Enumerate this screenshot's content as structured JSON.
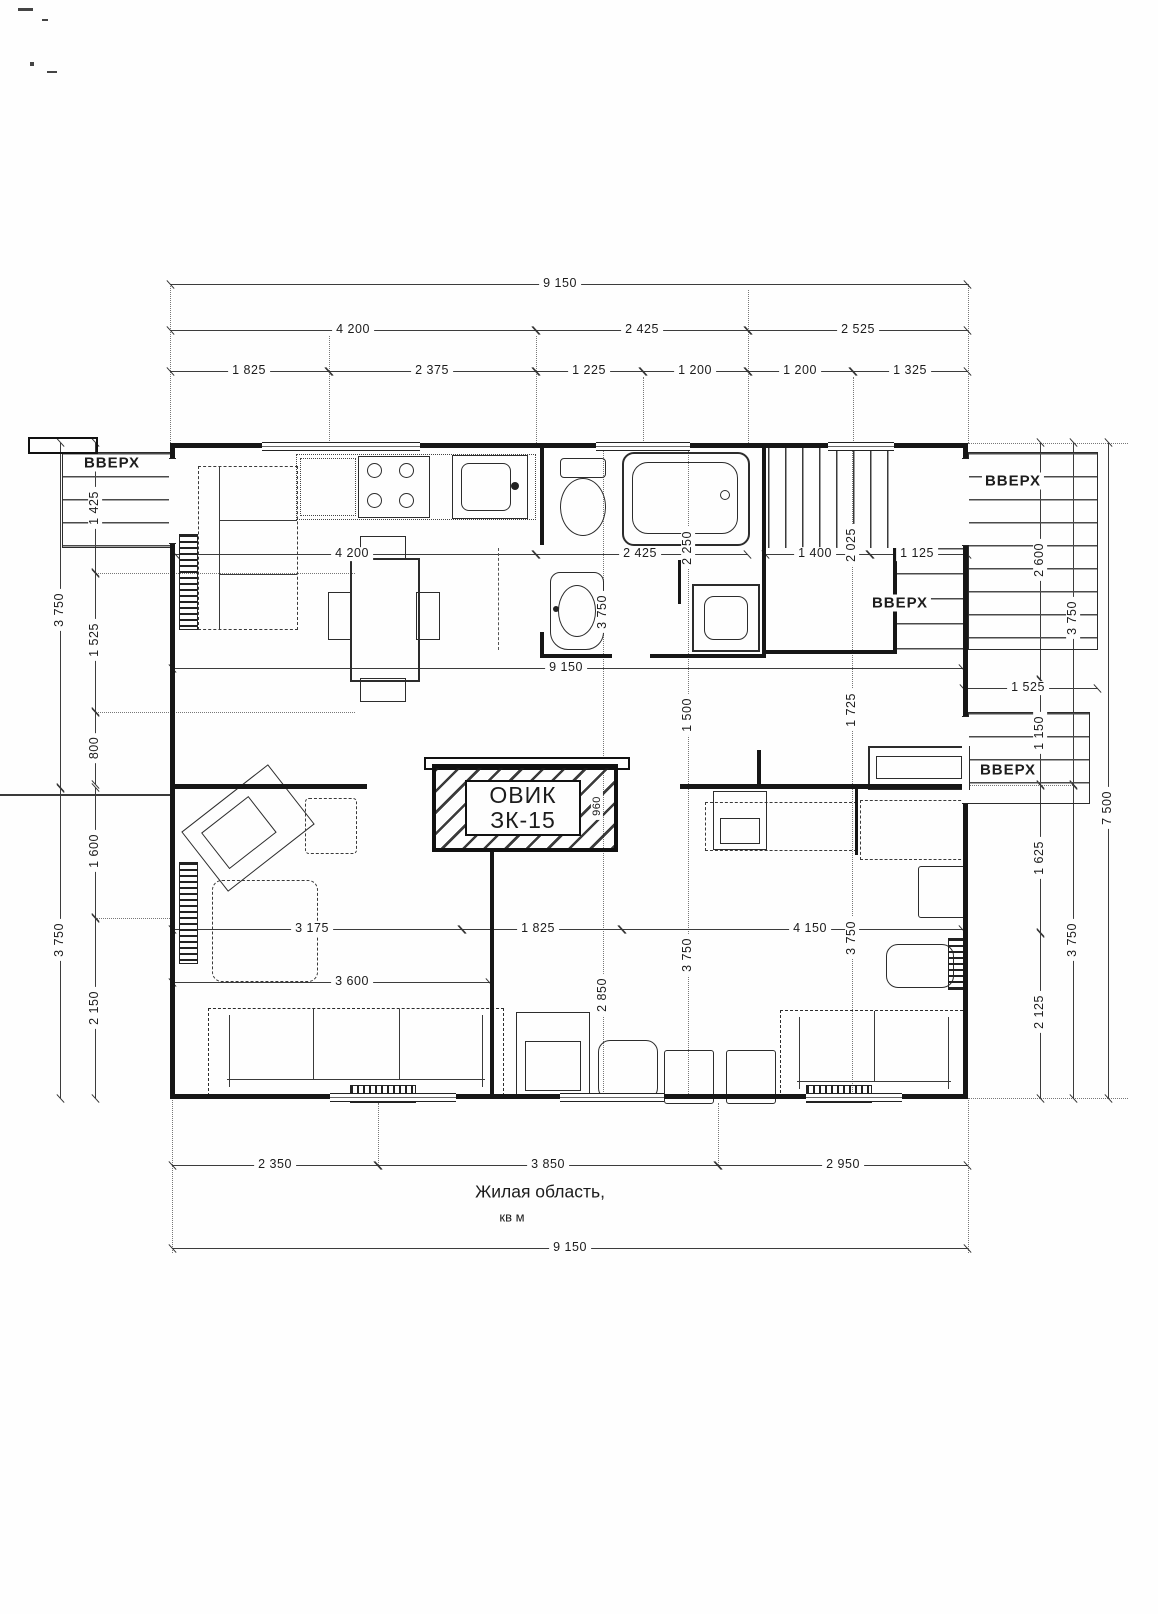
{
  "labels": {
    "up": "ВВЕРХ"
  },
  "furnace": {
    "line1": "ОВИК",
    "line2": "ЗК-15",
    "depth": "960"
  },
  "caption": {
    "line1": "Жилая область,",
    "line2": "кв м"
  },
  "colors": {
    "ink": "#1c1c1c",
    "paper": "#fefefe"
  },
  "dims": {
    "top_total": "9 150",
    "top_a": "4 200",
    "top_b": "2 425",
    "top_c": "2 525",
    "top_1": "1 825",
    "top_2": "2 375",
    "top_3": "1 225",
    "top_4": "1 200",
    "top_5": "1 200",
    "top_6": "1 325",
    "left_upper": "3 750",
    "left_lower": "3 750",
    "l1": "1 425",
    "l2": "1 525",
    "l3": "800",
    "l4": "1 600",
    "l5": "2 150",
    "r1": "2 600",
    "r2": "1 150",
    "r3": "1 625",
    "r4": "2 125",
    "right_upper": "3 750",
    "right_lower": "3 750",
    "right_total": "7 500",
    "m1": "4 200",
    "m2": "2 425",
    "m3": "1 400",
    "m4": "1 125",
    "v_tub": "2 250",
    "v_stair": "2 025",
    "v_bath": "3 750",
    "mid_total": "9 150",
    "mid_right": "1 525",
    "v_c1": "1 500",
    "v_r1": "1 725",
    "low_a": "3 175",
    "low_b": "1 825",
    "low_c": "4 150",
    "v_c2": "2 850",
    "v_c3": "3 750",
    "v_r2": "3 750",
    "sofa_w": "3 600",
    "bot_a": "2 350",
    "bot_b": "3 850",
    "bot_c": "2 950",
    "bot_total": "9 150"
  }
}
